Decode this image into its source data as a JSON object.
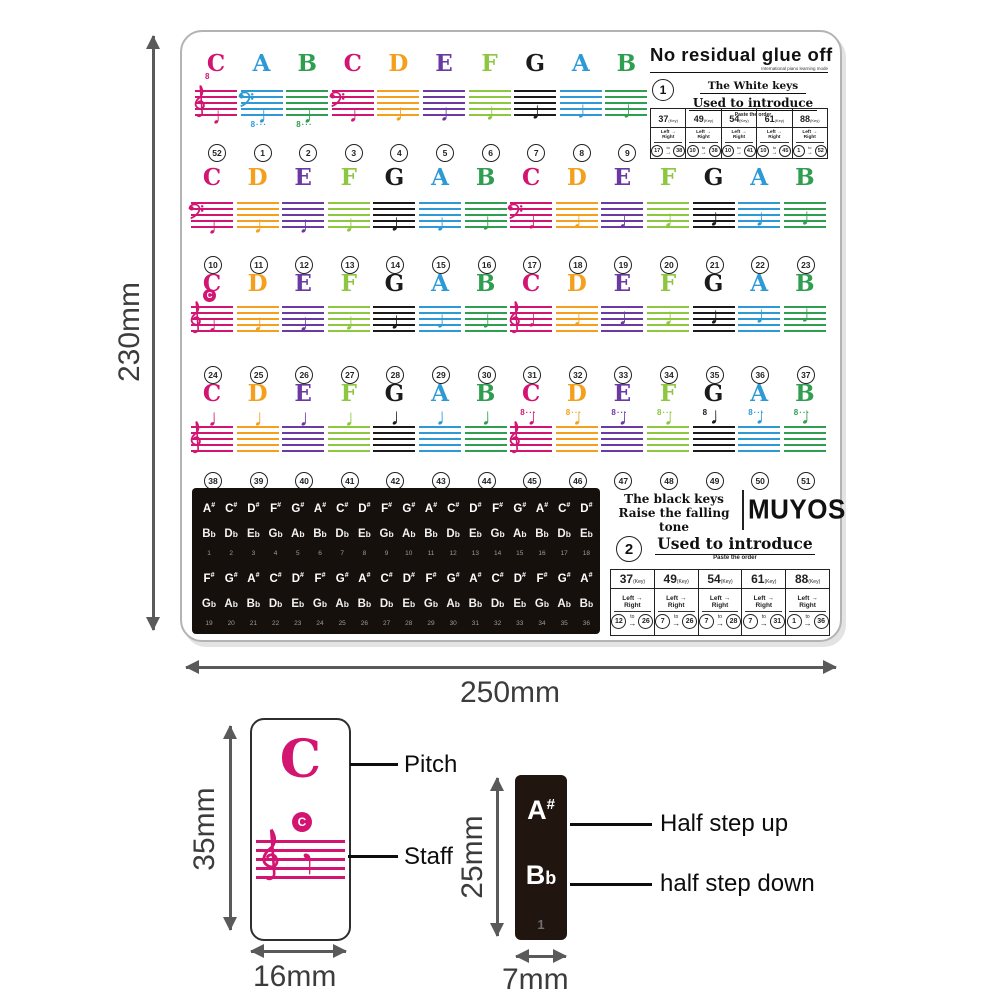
{
  "palette": {
    "C": "#d31572",
    "D": "#f4a01c",
    "E": "#6a3aa2",
    "F": "#8dc63f",
    "G": "#1b1b1b",
    "A": "#2d9ad6",
    "B": "#2f9e50"
  },
  "dims": {
    "sheet_height": "230mm",
    "sheet_width": "250mm",
    "white_height": "35mm",
    "white_width": "16mm",
    "black_height": "25mm",
    "black_width": "7mm"
  },
  "top_right": {
    "title": "No residual glue off",
    "subtitle": "International piano learning mode",
    "badge": "1",
    "white_keys": "The White keys",
    "used": "Used to introduce",
    "paste": "Paste the order",
    "table": {
      "key_suffix": "(Key)",
      "left": "Left",
      "right": "Right",
      "to": "to",
      "arrow": "→",
      "headers": [
        "37",
        "49",
        "54",
        "61",
        "88"
      ],
      "ranges": [
        [
          "17",
          "38"
        ],
        [
          "10",
          "38"
        ],
        [
          "10",
          "41"
        ],
        [
          "10",
          "45"
        ],
        [
          "1",
          "52"
        ]
      ]
    }
  },
  "bottom_right": {
    "black_keys": "The black keys",
    "raise": "Raise the falling tone",
    "logo": "MUYOS",
    "badge": "2",
    "used": "Used to introduce",
    "paste": "Paste the order",
    "table": {
      "key_suffix": "(Key)",
      "left": "Left",
      "right": "Right",
      "to": "to",
      "arrow": "→",
      "headers": [
        "37",
        "49",
        "54",
        "61",
        "88"
      ],
      "ranges": [
        [
          "12",
          "26"
        ],
        [
          "7",
          "26"
        ],
        [
          "7",
          "28"
        ],
        [
          "7",
          "31"
        ],
        [
          "1",
          "36"
        ]
      ]
    }
  },
  "groups": [
    {
      "letters": [
        "C",
        "A",
        "B",
        "C",
        "D",
        "E",
        "F",
        "G",
        "A",
        "B"
      ],
      "numbers": [
        "52",
        "1",
        "2",
        "3",
        "4",
        "5",
        "6",
        "7",
        "8",
        "9"
      ],
      "clefs": [
        {
          "i": 0,
          "type": "treble"
        },
        {
          "i": 1,
          "type": "bass"
        },
        {
          "i": 3,
          "type": "bass"
        }
      ],
      "marks": [
        {
          "i": 0,
          "pos": "above",
          "text": "8"
        },
        {
          "i": 1,
          "pos": "below",
          "text": "8···"
        },
        {
          "i": 2,
          "pos": "below",
          "text": "8···"
        }
      ],
      "middle_c": []
    },
    {
      "letters": [
        "C",
        "D",
        "E",
        "F",
        "G",
        "A",
        "B",
        "C",
        "D",
        "E",
        "F",
        "G",
        "A",
        "B"
      ],
      "numbers": [
        "10",
        "11",
        "12",
        "13",
        "14",
        "15",
        "16",
        "17",
        "18",
        "19",
        "20",
        "21",
        "22",
        "23"
      ],
      "clefs": [
        {
          "i": 0,
          "type": "bass"
        },
        {
          "i": 7,
          "type": "bass"
        }
      ],
      "marks": [],
      "middle_c": []
    },
    {
      "letters": [
        "C",
        "D",
        "E",
        "F",
        "G",
        "A",
        "B",
        "C",
        "D",
        "E",
        "F",
        "G",
        "A",
        "B"
      ],
      "numbers": [
        "24",
        "25",
        "26",
        "27",
        "28",
        "29",
        "30",
        "31",
        "32",
        "33",
        "34",
        "35",
        "36",
        "37"
      ],
      "clefs": [
        {
          "i": 0,
          "type": "treble"
        },
        {
          "i": 7,
          "type": "treble"
        }
      ],
      "marks": [],
      "middle_c": [
        0
      ],
      "middle_c_label": "C"
    },
    {
      "letters": [
        "C",
        "D",
        "E",
        "F",
        "G",
        "A",
        "B",
        "C",
        "D",
        "E",
        "F",
        "G",
        "A",
        "B"
      ],
      "numbers": [
        "38",
        "39",
        "40",
        "41",
        "42",
        "43",
        "44",
        "45",
        "46",
        "47",
        "48",
        "49",
        "50",
        "51"
      ],
      "clefs": [
        {
          "i": 0,
          "type": "treble"
        },
        {
          "i": 7,
          "type": "treble"
        }
      ],
      "marks": [
        {
          "i": 7,
          "pos": "above",
          "text": "8···"
        },
        {
          "i": 8,
          "pos": "above",
          "text": "8···"
        },
        {
          "i": 9,
          "pos": "above",
          "text": "8···"
        },
        {
          "i": 10,
          "pos": "above",
          "text": "8···"
        },
        {
          "i": 11,
          "pos": "above",
          "text": "8"
        },
        {
          "i": 12,
          "pos": "above",
          "text": "8···"
        },
        {
          "i": 13,
          "pos": "above",
          "text": "8···"
        }
      ],
      "middle_c": []
    }
  ],
  "black_panel": {
    "rows": [
      {
        "sharps": [
          "A#",
          "C#",
          "D#",
          "F#",
          "G#",
          "A#",
          "C#",
          "D#",
          "F#",
          "G#",
          "A#",
          "C#",
          "D#",
          "F#",
          "G#",
          "A#",
          "C#",
          "D#"
        ],
        "flats": [
          "Bb",
          "Db",
          "Eb",
          "Gb",
          "Ab",
          "Bb",
          "Db",
          "Eb",
          "Gb",
          "Ab",
          "Bb",
          "Db",
          "Eb",
          "Gb",
          "Ab",
          "Bb",
          "Db",
          "Eb"
        ],
        "numbers": [
          "1",
          "2",
          "3",
          "4",
          "5",
          "6",
          "7",
          "8",
          "9",
          "10",
          "11",
          "12",
          "13",
          "14",
          "15",
          "16",
          "17",
          "18"
        ]
      },
      {
        "sharps": [
          "F#",
          "G#",
          "A#",
          "C#",
          "D#",
          "F#",
          "G#",
          "A#",
          "C#",
          "D#",
          "F#",
          "G#",
          "A#",
          "C#",
          "D#",
          "F#",
          "G#",
          "A#"
        ],
        "flats": [
          "Gb",
          "Ab",
          "Bb",
          "Db",
          "Eb",
          "Gb",
          "Ab",
          "Bb",
          "Db",
          "Eb",
          "Gb",
          "Ab",
          "Bb",
          "Db",
          "Eb",
          "Gb",
          "Ab",
          "Bb"
        ],
        "numbers": [
          "19",
          "20",
          "21",
          "22",
          "23",
          "24",
          "25",
          "26",
          "27",
          "28",
          "29",
          "30",
          "31",
          "32",
          "33",
          "34",
          "35",
          "36"
        ]
      }
    ]
  },
  "detail_white": {
    "pitch_letter": "C",
    "circle_letter": "C",
    "pitch_label": "Pitch",
    "staff_label": "Staff"
  },
  "detail_black": {
    "sharp_base": "A",
    "sharp_sign": "#",
    "flat_base": "B",
    "flat_sign": "b",
    "number": "1",
    "up_label": "Half step up",
    "down_label": "half step down"
  }
}
